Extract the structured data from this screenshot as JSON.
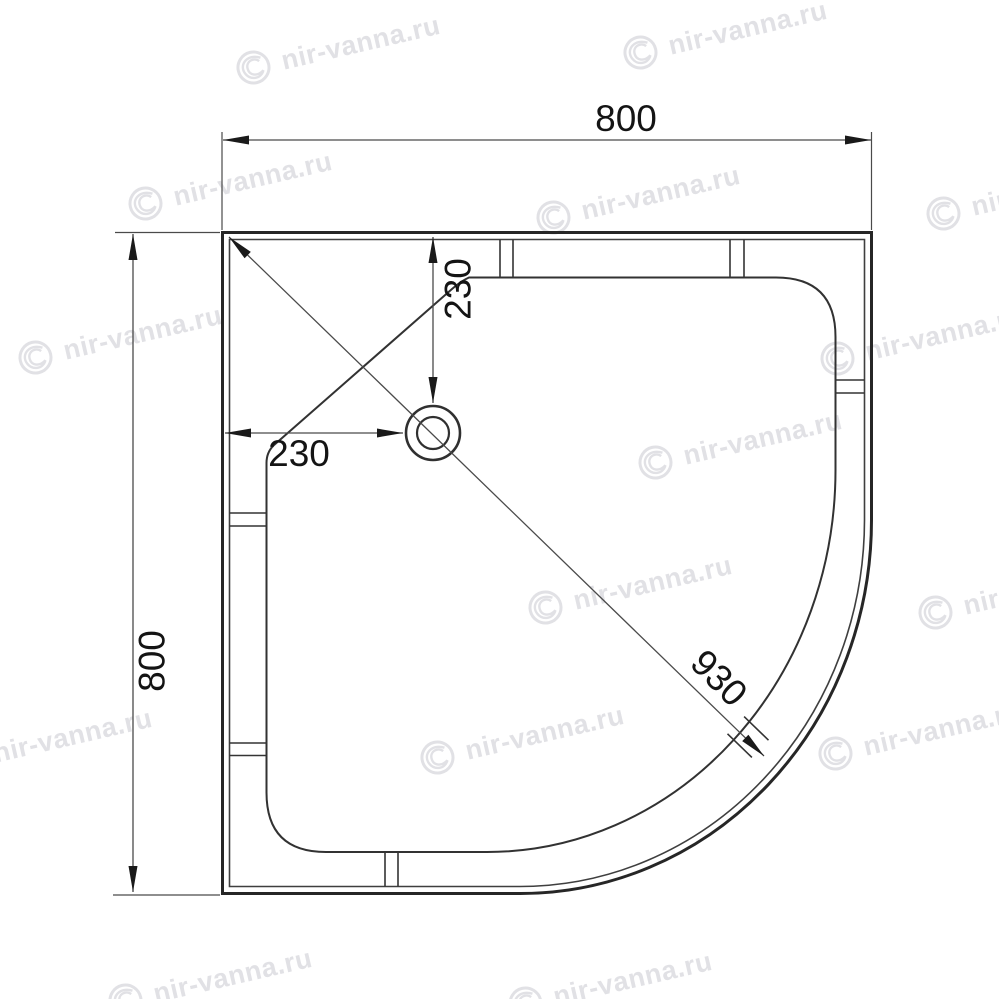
{
  "dimensions": {
    "overall_width": "800",
    "overall_depth": "800",
    "drain_offset_horizontal": "230",
    "drain_offset_vertical": "230",
    "diagonal": "930"
  },
  "watermark": {
    "text": "nir-vanna.ru",
    "logo": "swirl-circle-icon",
    "color": "#e1e1e5"
  },
  "colors": {
    "outline": "#262626",
    "dimension_lines": "#4a4a4a",
    "text": "#141414",
    "background": "#ffffff"
  }
}
